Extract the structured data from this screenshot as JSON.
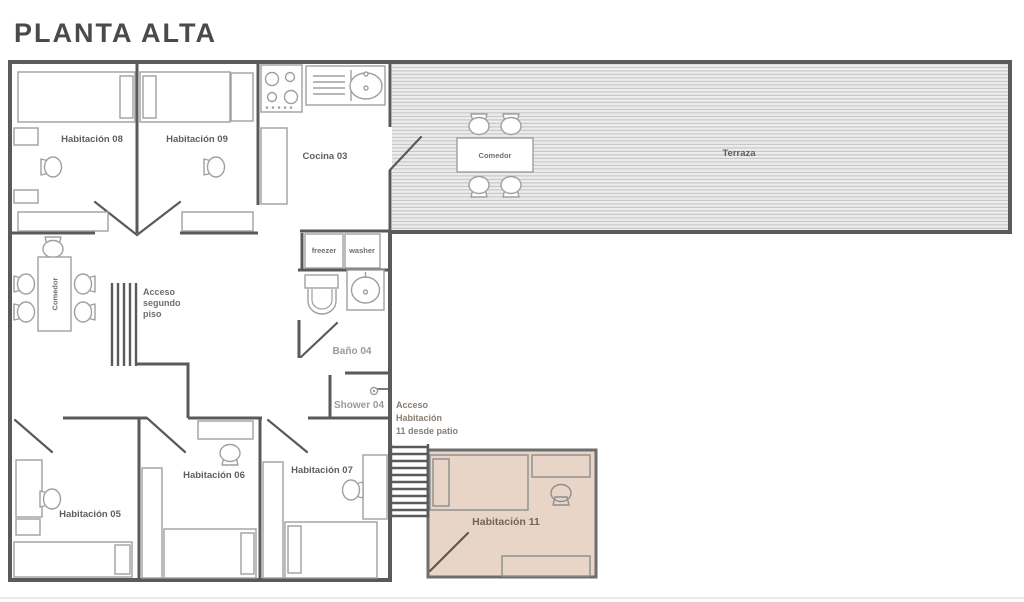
{
  "title": "PLANTA ALTA",
  "rooms": {
    "habitacion_08": "Habitación 08",
    "habitacion_09": "Habitación 09",
    "cocina_03": "Cocina 03",
    "terraza": "Terraza",
    "comedor_terraza": "Comedor",
    "comedor_interior": "Comedor",
    "bano_04": "Baño 04",
    "shower_04": "Shower 04",
    "habitacion_05": "Habitación 05",
    "habitacion_06": "Habitación 06",
    "habitacion_07": "Habitación 07",
    "habitacion_11": "Habitación 11"
  },
  "annotations": {
    "acceso_segundo_piso": [
      "Acceso",
      "segundo",
      "piso"
    ],
    "acceso_habitacion_11": [
      "Acceso",
      "Habitación",
      "11 desde patio"
    ]
  },
  "appliances": {
    "freezer": "freezer",
    "washer": "washer"
  },
  "colors": {
    "wall": "#5a5a5a",
    "furniture_outline": "#9f9f9f",
    "room_label": "#5f5f5f",
    "muted_label": "#9a9a9a",
    "terrace_fill": "#ececec",
    "terrace_hatch_line": "#c6c6c6",
    "habitacion_11_fill": "#e8d5c8",
    "title": "#4a4a4a"
  }
}
